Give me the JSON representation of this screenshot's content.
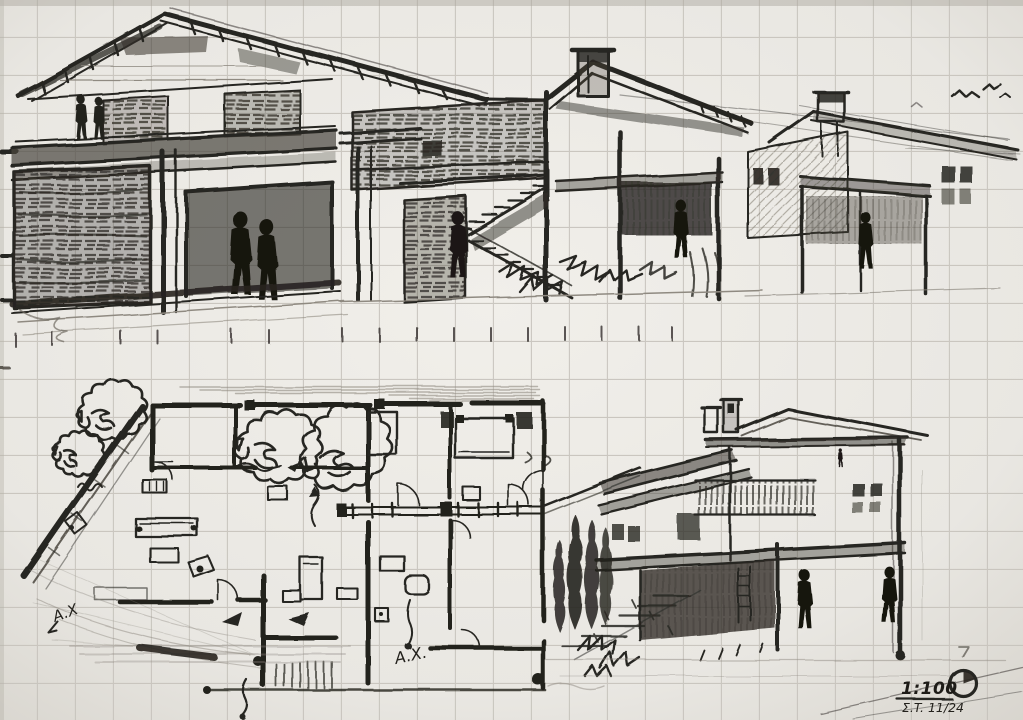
{
  "palette": {
    "paper": "#eae8e3",
    "paper_edge": "#d7d4cd",
    "grid_line": "#c6c2bb",
    "graphite_dark": "#272520",
    "graphite_mid": "#55514a",
    "graphite_light": "#8f8a81"
  },
  "annotations": {
    "plan_axis_label_left": "A.X",
    "plan_axis_label_right": "A.X.",
    "scale_note": "1:100",
    "signature": "Σ.T. 11/24"
  }
}
